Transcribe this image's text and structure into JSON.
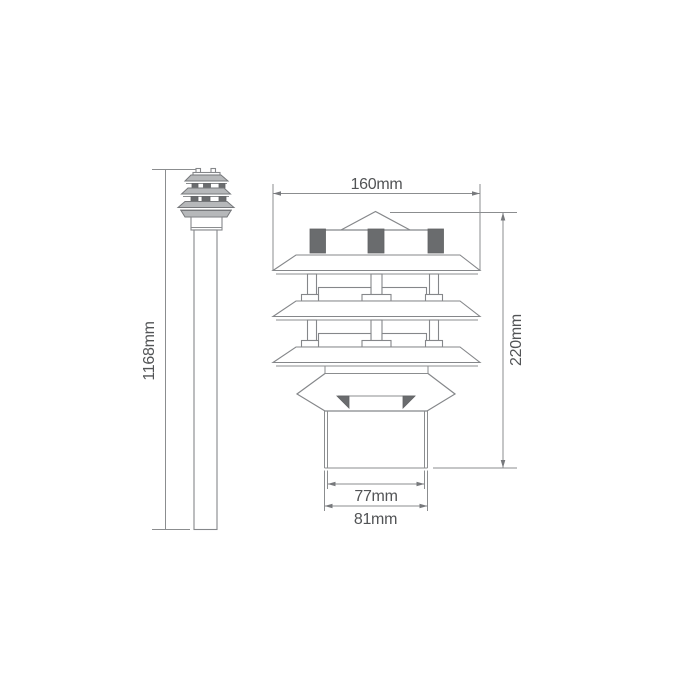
{
  "diagram": {
    "type": "technical-dimension-drawing",
    "subject": "three-tier pagoda post light",
    "left_view": {
      "name": "full post elevation",
      "height_label": "1168mm"
    },
    "right_view": {
      "name": "lantern head detail",
      "width_label": "160mm",
      "height_label": "220mm",
      "base_inner_width_label": "77mm",
      "base_outer_width_label": "81mm"
    },
    "colors": {
      "background": "#ffffff",
      "line": "#8b8d8f",
      "dark_fill": "#6a6c6e",
      "light_fill": "#b6b8ba",
      "text": "#525456"
    }
  }
}
